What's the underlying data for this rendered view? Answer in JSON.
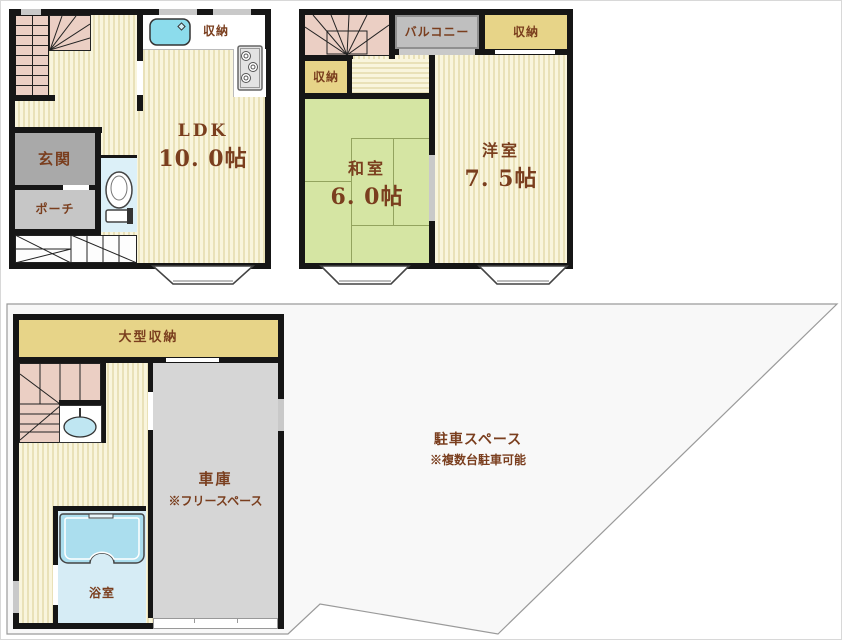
{
  "palette": {
    "wall": "#161616",
    "floor_base": "#f9f5dd",
    "floor_stripe": "#e9e1b8",
    "tatami": "#d5e5a3",
    "tatami_line": "#93a35e",
    "storage_tan": "#e7d488",
    "stair_pink": "#ebcfc4",
    "genkan_gray": "#a9a9a9",
    "porch_gray": "#c6c6c6",
    "balcony_gray": "#bfbfbf",
    "garage_gray": "#d6d6d6",
    "bath_blue": "#d6ecf5",
    "tub_cyan": "#abdeee",
    "sink_cyan": "#8cdcec",
    "toilet_blue": "#dcf0f8",
    "window_gray": "#c9c9c9",
    "lot_fill": "#f8f8f8",
    "lot_stroke": "#9a9a9a",
    "text_brown": "#7a3e1e"
  },
  "floor2_left": {
    "closet": "収納",
    "room": "LDK",
    "size": "10. 0帖",
    "entrance": "玄関",
    "porch": "ポーチ"
  },
  "floor2_right": {
    "balcony": "バルコニー",
    "closet_top": "収納",
    "closet_left": "収納",
    "tatami_room": "和室",
    "tatami_size": "6. 0帖",
    "western_room": "洋室",
    "western_size": "7. 5帖"
  },
  "floor1": {
    "large_storage": "大型収納",
    "garage": "車庫",
    "garage_note": "※フリースペース",
    "bath": "浴室",
    "parking": "駐車スペース",
    "parking_note": "※複数台駐車可能"
  }
}
